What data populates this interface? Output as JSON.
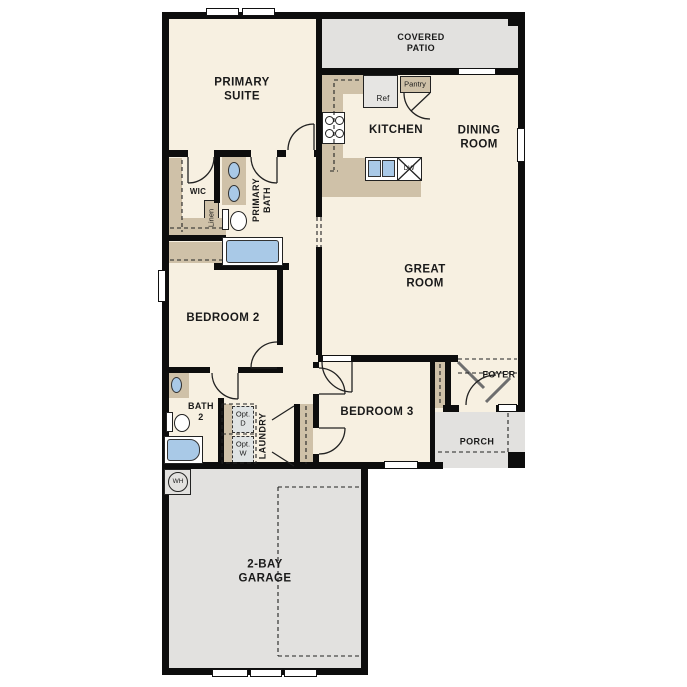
{
  "colors": {
    "room": "#f7f0e1",
    "outdoor": "#e2e1df",
    "cabinet": "#cfc1a8",
    "fixture": "#a9c9e7",
    "appliance": "#e6e5e3",
    "optbox": "#dfe3e3",
    "wall": "#0d0d0d",
    "text": "#1a1a1a"
  },
  "rooms": {
    "covered_patio": "COVERED\nPATIO",
    "primary_suite": "PRIMARY\nSUITE",
    "kitchen": "KITCHEN",
    "dining_room": "DINING\nROOM",
    "great_room": "GREAT\nROOM",
    "wic": "WIC",
    "linen": "Linen",
    "primary_bath": "PRIMARY\nBATH",
    "bedroom2": "BEDROOM 2",
    "bath2": "BATH\n2",
    "laundry": "LAUNDRY",
    "opt_dryer": "Opt.\nD",
    "opt_washer": "Opt.\nW",
    "bedroom3": "BEDROOM 3",
    "foyer": "FOYER",
    "porch": "PORCH",
    "garage": "2-BAY\nGARAGE",
    "water_heater": "WH",
    "refrigerator": "Ref",
    "pantry": "Pantry",
    "dishwasher": "DW"
  }
}
